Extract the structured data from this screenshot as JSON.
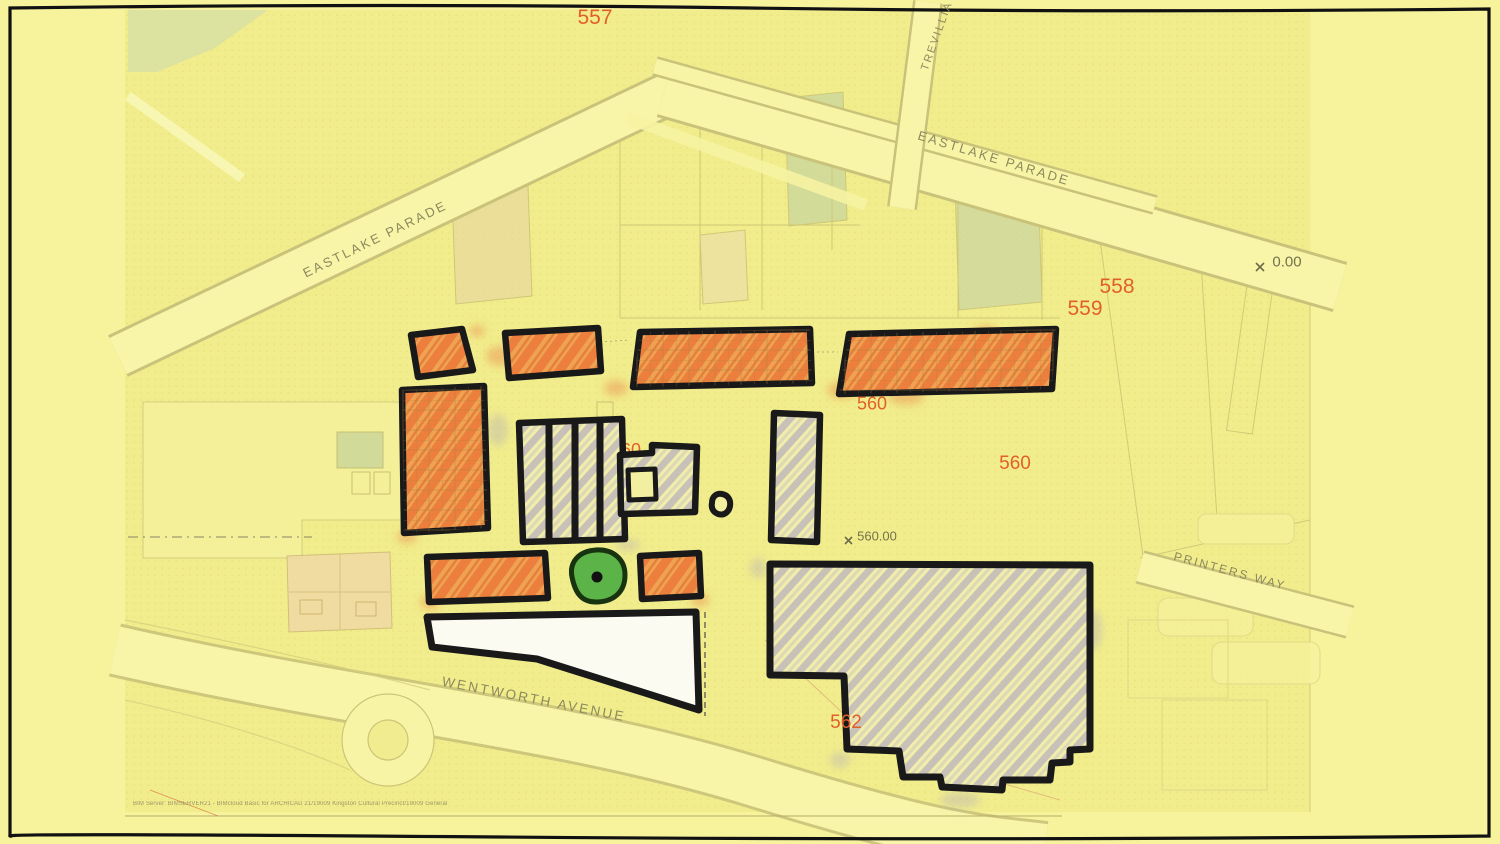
{
  "sheet": {
    "title": "site-plan-sketch",
    "footer_text": "BIM Server: BIMSERVER21 - BIMcloud Basic for ARCHICAD 21/19009 Kingston Cultural Precinct/19009 General"
  },
  "streets": {
    "eastlake_parade_west": "EASTLAKE PARADE",
    "eastlake_parade_east": "EASTLAKE PARADE",
    "trevillia": "TREVILLIA",
    "printers_way": "PRINTERS WAY",
    "wentworth_avenue": "WENTWORTH AVENUE"
  },
  "zone_labels": {
    "z557": "557",
    "z558": "558",
    "z559": "559",
    "z560_north": "560",
    "z560_center": "560",
    "z560_east": "560",
    "z562": "562"
  },
  "datums": {
    "datum_east": "0.00",
    "datum_center": "560.00"
  },
  "colors": {
    "paper": "#f7f39d",
    "map_tint": "#f1ed8c",
    "road_fill": "#f8f5a8",
    "road_edge": "#c9c27a",
    "street_label": "#8b895e",
    "zone_label": "#e25f2b",
    "datum_label": "#74724c",
    "sketch_outline": "#191919",
    "building_orange_base": "#efa352",
    "building_orange_hatch": "#e8602c",
    "building_gray_hatch": "#aba3c2",
    "building_white": "#fcfbf2",
    "tree_green": "#5cb348",
    "parcel_green": "#c9d59c",
    "parcel_tan": "#e9d99c",
    "parcel_peach": "#f0d8a6"
  }
}
